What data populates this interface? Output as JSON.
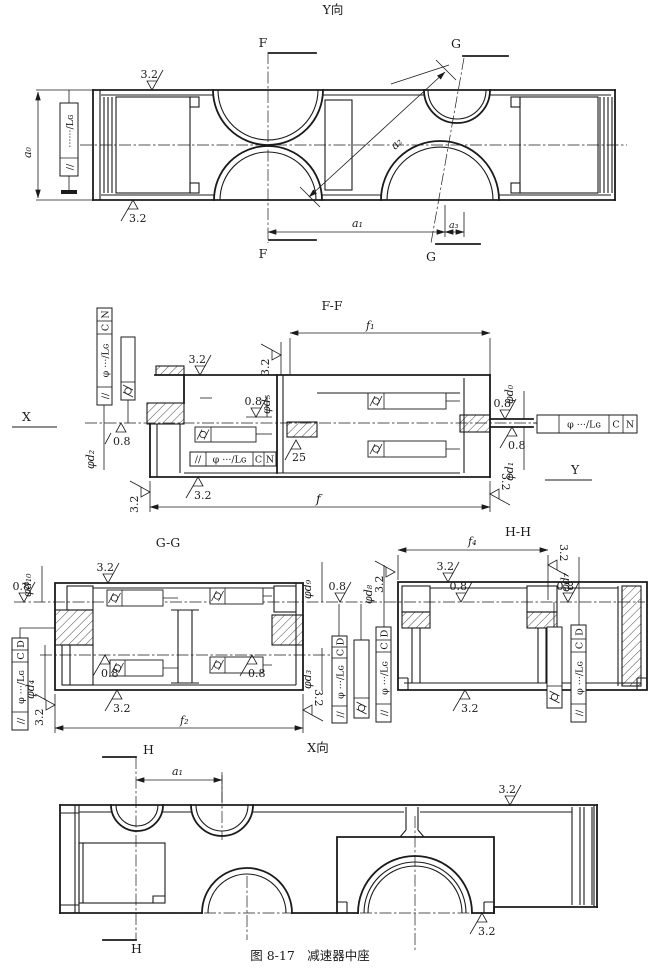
{
  "figure": {
    "caption": "图 8-17　减速器中座"
  },
  "views": {
    "top": "Y向",
    "ff": "F-F",
    "gg": "G-G",
    "hh": "H-H",
    "x": "X向"
  },
  "sections": {
    "f": "F",
    "g": "G",
    "h": "H"
  },
  "axes": {
    "x": "X",
    "y": "Y"
  },
  "dims": {
    "a0": "a₀",
    "a1": "a₁",
    "a2": "a₂",
    "a3": "a₃",
    "f": "f",
    "f1": "f₁",
    "f2": "f₂",
    "f4": "f₄"
  },
  "dia": {
    "d0": "φd₀",
    "d1": "φd₁",
    "d2": "φd₂",
    "d3": "φd₃",
    "d4": "φd₄",
    "d5": "φd₅",
    "d7": "φd₇",
    "d8": "φd₈",
    "d9": "φd₉",
    "d10": "φd₁₀"
  },
  "rough": {
    "r08": "0.8",
    "r32": "3.2",
    "r25": "25"
  },
  "frames": {
    "parallel": "//",
    "tol": "φ ···/Lɢ",
    "tol_dots": "······/Lɢ",
    "c": "C",
    "n": "N",
    "d": "D"
  }
}
